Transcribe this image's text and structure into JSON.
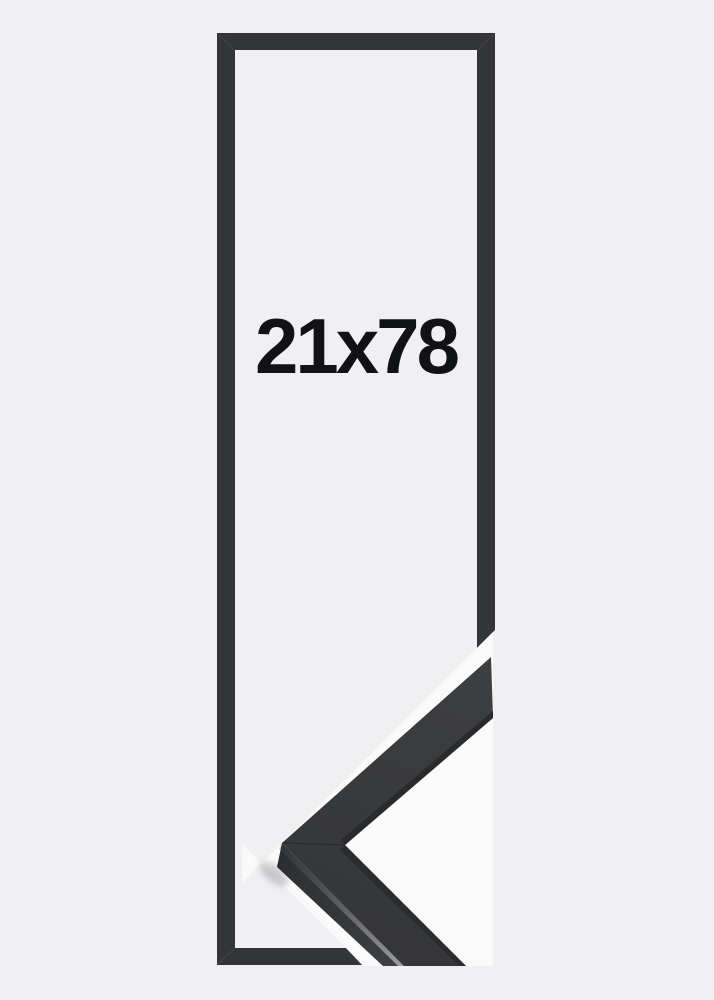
{
  "product": {
    "size_label": "21x78"
  },
  "colors": {
    "page_background": "#f0f0f2",
    "photo_background": "#fafafa",
    "frame_outline": "#333537",
    "corner_top_face": "#3a3b3d",
    "corner_inner_lip": "#282a2c",
    "corner_side_face": "#313335",
    "size_text": "#111214"
  }
}
